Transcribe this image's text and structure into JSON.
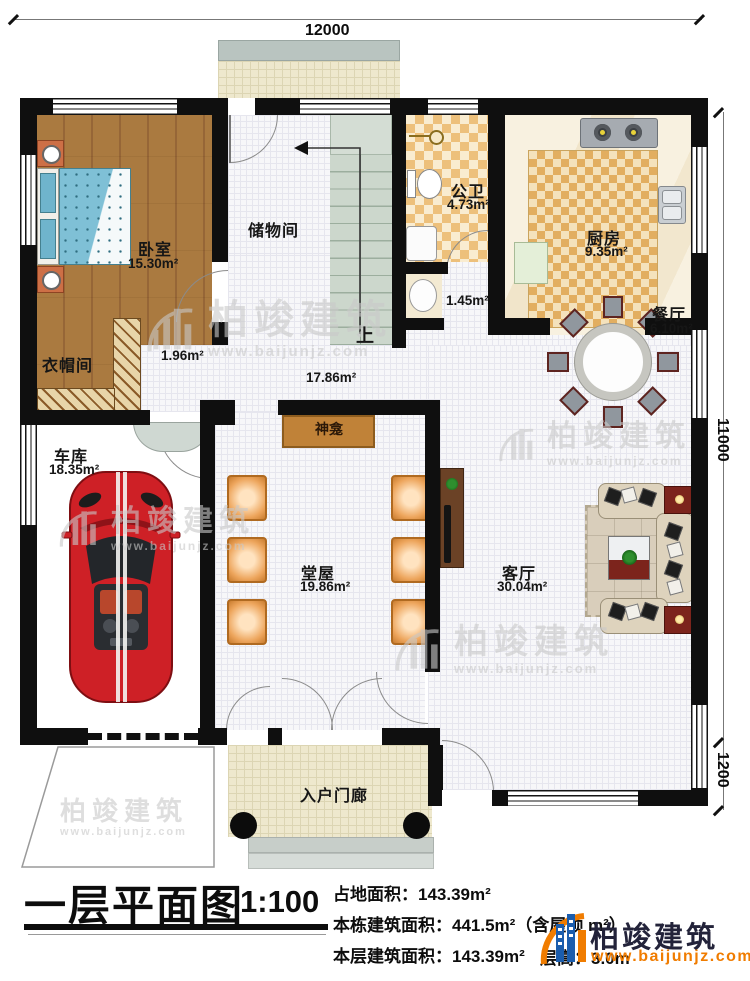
{
  "dimensions": {
    "top": "12000",
    "right_main": "11000",
    "right_lower": "1200"
  },
  "rooms": {
    "bedroom": {
      "name": "卧室",
      "area": "15.30m²"
    },
    "storage": {
      "name": "储物间"
    },
    "bath": {
      "name": "公卫",
      "area": "4.73m²"
    },
    "kitchen": {
      "name": "厨房",
      "area": "9.35m²"
    },
    "dining": {
      "name": "餐厅",
      "area": "6.10m²"
    },
    "cloakroom": {
      "name": "衣帽间"
    },
    "corridor": {
      "area": "1.96m²"
    },
    "hall": {
      "area": "17.86m²"
    },
    "niche": {
      "area": "1.45m²"
    },
    "garage": {
      "name": "车库",
      "area": "18.35m²"
    },
    "main_hall": {
      "name": "堂屋",
      "area": "19.86m²"
    },
    "living": {
      "name": "客厅",
      "area": "30.04m²"
    },
    "porch": {
      "name": "入户门廊"
    },
    "shrine": {
      "name": "神龛"
    },
    "stairs": {
      "up": "上"
    }
  },
  "watermark": {
    "brand": "柏竣建筑",
    "url": "www.baijunjz.com"
  },
  "title_block": {
    "title": "一层平面图",
    "scale": "1:100",
    "land_area": "占地面积：143.39m²",
    "total_area": "本栋建筑面积：441.5m²（含屋顶 m²）",
    "floor_area": "本层建筑面积：143.39m²",
    "height": "层高：3.0m"
  },
  "logo": {
    "brand": "柏竣建筑",
    "url": "www.baijunjz.com"
  }
}
